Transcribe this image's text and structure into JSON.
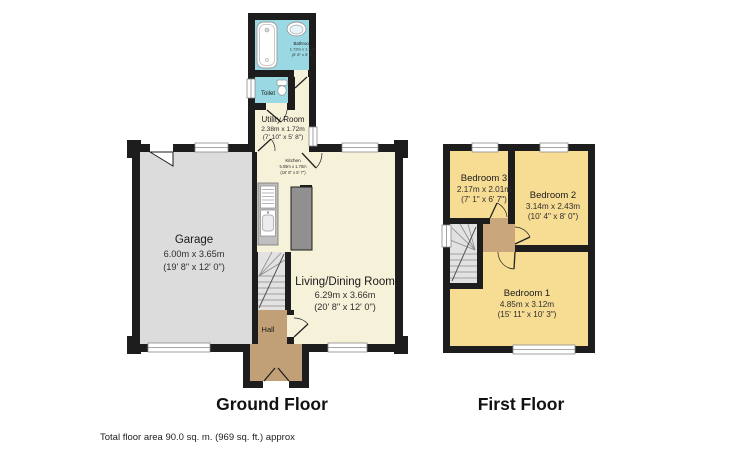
{
  "document": {
    "type": "estate-agent-floorplan",
    "footer_note": "Total floor area 90.0 sq. m. (969 sq. ft.) approx"
  },
  "colors": {
    "wall": "#1d1d1d",
    "room_cream": "#f6f1d9",
    "room_cyan": "#9ad9e3",
    "room_gray": "#dcdcdc",
    "room_yellow": "#f7dd94",
    "hall_tan": "#c2a077",
    "stairs_gray": "#e2e2e2",
    "counter_gray": "#bfbfbf",
    "chimney_gray": "#909090",
    "window_white": "#ffffff"
  },
  "floors": {
    "ground": {
      "title": "Ground Floor",
      "rooms": {
        "bathroom": {
          "name": "Bathroom",
          "metric": "1.72m x 1.73m",
          "imperial": "(5' 8\" x 5' 8\")"
        },
        "toilet": {
          "name": "Toilet"
        },
        "utility": {
          "name": "Utility Room",
          "metric": "2.38m x 1.72m",
          "imperial": "(7' 10\" x 5' 8\")"
        },
        "kitchen": {
          "name": "Kitchen",
          "metric": "5.09m x 1.70m",
          "imperial": "(16' 8\" x 5' 7\")"
        },
        "garage": {
          "name": "Garage",
          "metric": "6.00m x 3.65m",
          "imperial": "(19' 8\" x 12' 0\")"
        },
        "living": {
          "name": "Living/Dining Room",
          "metric": "6.29m x 3.66m",
          "imperial": "(20' 8\" x 12' 0\")"
        },
        "hall": {
          "name": "Hall"
        }
      }
    },
    "first": {
      "title": "First Floor",
      "rooms": {
        "bedroom3": {
          "name": "Bedroom 3",
          "metric": "2.17m x 2.01m",
          "imperial": "(7' 1\" x 6' 7\")"
        },
        "bedroom2": {
          "name": "Bedroom 2",
          "metric": "3.14m x 2.43m",
          "imperial": "(10' 4\" x 8' 0\")"
        },
        "bedroom1": {
          "name": "Bedroom 1",
          "metric": "4.85m x 3.12m",
          "imperial": "(15' 11\" x 10' 3\")"
        }
      }
    }
  }
}
